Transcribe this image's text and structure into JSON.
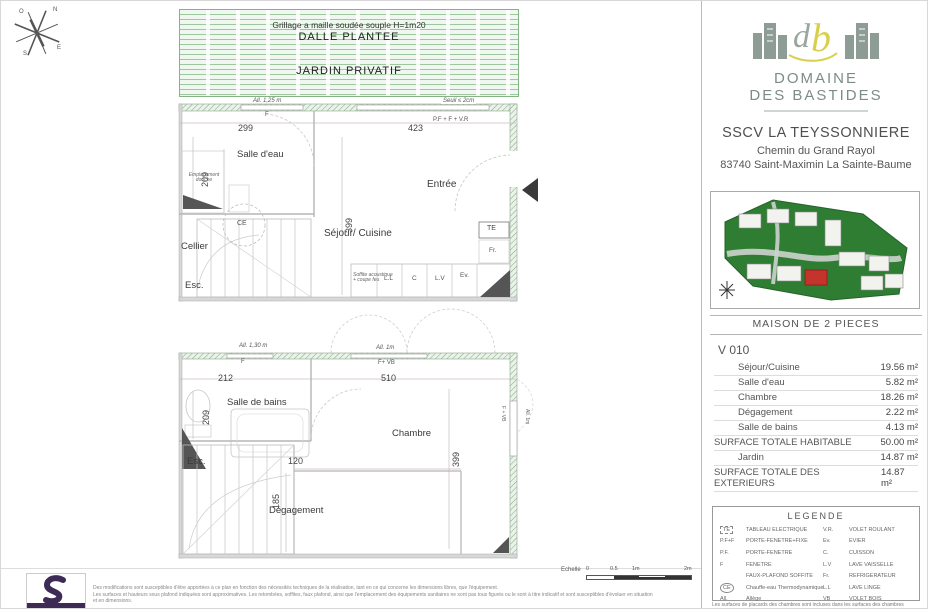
{
  "compass": {
    "n": "N",
    "e": "E",
    "s": "S",
    "o": "O"
  },
  "upper_plan": {
    "grillage": "Grillage a maille soudée souple H=1m20",
    "dalle": "DALLE PLANTEE",
    "jardin": "JARDIN PRIVATIF",
    "allege": "All. 1,25 m",
    "seuil": "Seuil ≤ 2cm",
    "window_f": "F",
    "dim_width_left": "299",
    "dim_width_right": "423",
    "door_label": "P.F + F + V.R",
    "dim_209": "209",
    "dim_399": "399",
    "room_salle_eau": "Salle d'eau",
    "emplacement_douche": "Emplacement douche",
    "room_entree": "Entrée",
    "ce": "CE",
    "room_cellier": "Cellier",
    "esc": "Esc.",
    "room_sejour": "Séjour/ Cuisine",
    "soffite_line1": "Soffite acoustique",
    "soffite_line2": "+ coupe feu",
    "te": "TE",
    "fr": "Fr.",
    "ll": "L.L",
    "c": "C",
    "lv": "L.V",
    "ev": "Ev."
  },
  "lower_plan": {
    "allege_130": "All. 1,30 m",
    "allege_1m": "All. 1m",
    "window_f": "F",
    "f_vb": "F+ VB",
    "dim_212": "212",
    "dim_510": "510",
    "dim_209": "209",
    "dim_399": "399",
    "dim_120": "120",
    "dim_185": "185",
    "room_salle_bains": "Salle de bains",
    "room_chambre": "Chambre",
    "esc": "Esc.",
    "room_degagement": "Dégagement",
    "f_vb_right": "F + VB",
    "allege_right": "All. 1m"
  },
  "sidebar": {
    "brand_line1": "DOMAINE",
    "brand_line2": "DES BASTIDES",
    "company": "SSCV LA TEYSSONNIERE",
    "address_line1": "Chemin du Grand Rayol",
    "address_line2": "83740 Saint-Maximin La Sainte-Baume",
    "section_title": "MAISON DE 2 PIECES",
    "unit_code": "V 010",
    "table": {
      "rows": [
        {
          "label": "Séjour/Cuisine",
          "value": "19.56 m²"
        },
        {
          "label": "Salle d'eau",
          "value": "5.82 m²"
        },
        {
          "label": "Chambre",
          "value": "18.26 m²"
        },
        {
          "label": "Dégagement",
          "value": "2.22 m²"
        },
        {
          "label": "Salle de bains",
          "value": "4.13 m²"
        },
        {
          "label": "SURFACE TOTALE HABITABLE",
          "value": "50.00 m²"
        },
        {
          "label": "Jardin",
          "value": "14.87 m²"
        },
        {
          "label": "SURFACE TOTALE DES EXTERIEURS",
          "value": "14.87 m²"
        }
      ]
    },
    "legend": {
      "title": "LEGENDE",
      "left": [
        {
          "abbr": "TE",
          "desc": "TABLEAU ELECTRIQUE"
        },
        {
          "abbr": "P.F+F",
          "desc": "PORTE-FENETRE+FIXE"
        },
        {
          "abbr": "P.F.",
          "desc": "PORTE-FENETRE"
        },
        {
          "abbr": "F",
          "desc": "FENETRE"
        },
        {
          "abbr": "",
          "desc": "FAUX-PLAFOND SOFFITE"
        },
        {
          "abbr": "CE",
          "desc": "Chauffe-eau Thermodynamique"
        },
        {
          "abbr": "All.",
          "desc": "Allège"
        }
      ],
      "right": [
        {
          "abbr": "V.R.",
          "desc": "VOLET ROULANT"
        },
        {
          "abbr": "Ev.",
          "desc": "EVIER"
        },
        {
          "abbr": "C.",
          "desc": "CUISSON"
        },
        {
          "abbr": "L.V",
          "desc": "LAVE VAISSELLE"
        },
        {
          "abbr": "Fr.",
          "desc": "REFRIGERATEUR"
        },
        {
          "abbr": "L.L",
          "desc": "LAVE LINGE"
        },
        {
          "abbr": "VB",
          "desc": "VOLET BOIS"
        }
      ]
    },
    "footnote": "Les surfaces de placards des chambres sont incluses dans les surfaces des chambres"
  },
  "footer": {
    "disclaimer_line1": "Des modifications sont susceptibles d'être apportées à ce plan en fonction des nécessités techniques de la réalisation, tant en ce qui concerne les dimensions libres, que l'équipement.",
    "disclaimer_line2": "Les surfaces et hauteurs sous plafond indiquées sont approximatives. Les retombées, soffites, faux plafond, ainsi que l'emplacement des équipements sanitaires ne sont pas tous figurés ou le sont à titre indicatif et sont susceptibles d'évoluer en situation et en dimensions.",
    "scale_label": "Echelle",
    "scale_ticks": [
      "0",
      "0.5",
      "1m",
      "2m"
    ]
  }
}
